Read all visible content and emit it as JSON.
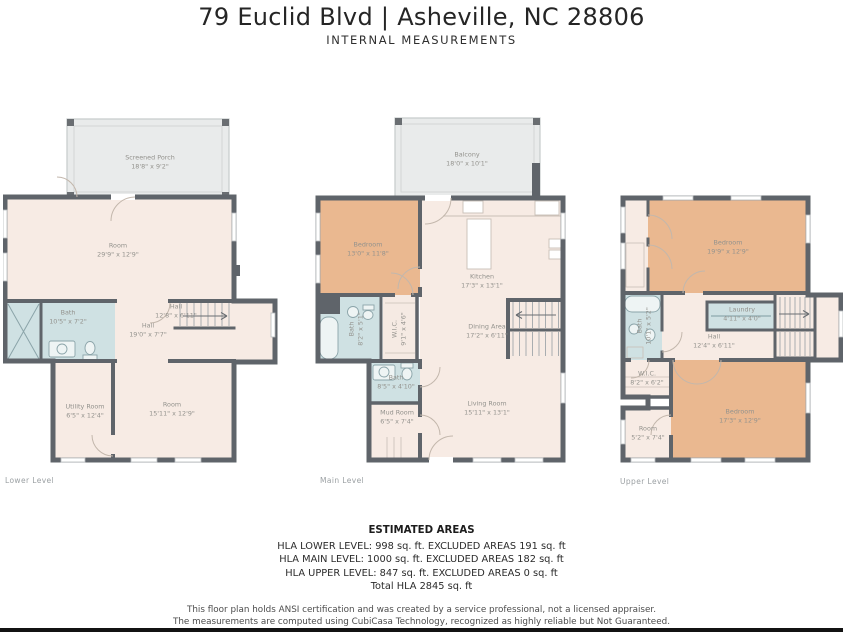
{
  "header": {
    "title": "79 Euclid Blvd | Asheville, NC 28806",
    "subtitle": "INTERNAL MEASUREMENTS"
  },
  "levels": [
    {
      "label": "Lower Level",
      "rooms": [
        {
          "name": "Screened Porch",
          "dims": "18'8\" x 9'2\""
        },
        {
          "name": "Room",
          "dims": "29'9\" x 12'9\""
        },
        {
          "name": "Bath",
          "dims": "10'5\" x 7'2\""
        },
        {
          "name": "Hall",
          "dims": "12'8\" x 6'11\""
        },
        {
          "name": "Hall",
          "dims": "19'0\" x 7'7\""
        },
        {
          "name": "Utility Room",
          "dims": "6'5\" x 12'4\""
        },
        {
          "name": "Room",
          "dims": "15'11\" x 12'9\""
        }
      ]
    },
    {
      "label": "Main Level",
      "rooms": [
        {
          "name": "Balcony",
          "dims": "18'0\" x 10'1\""
        },
        {
          "name": "Bedroom",
          "dims": "13'0\" x 11'8\""
        },
        {
          "name": "Kitchen",
          "dims": "17'3\" x 13'1\""
        },
        {
          "name": "Bath",
          "dims": "8'2\" x 5'1\""
        },
        {
          "name": "W.I.C.",
          "dims": "9'1\" x 4'6\""
        },
        {
          "name": "Dining Area",
          "dims": "17'2\" x 6'11\""
        },
        {
          "name": "Bath",
          "dims": "8'5\" x 4'10\""
        },
        {
          "name": "Mud Room",
          "dims": "6'5\" x 7'4\""
        },
        {
          "name": "Living Room",
          "dims": "15'11\" x 13'1\""
        }
      ]
    },
    {
      "label": "Upper Level",
      "rooms": [
        {
          "name": "Bedroom",
          "dims": "19'9\" x 12'9\""
        },
        {
          "name": "Bath",
          "dims": "10'1\" x 5'2\""
        },
        {
          "name": "Laundry",
          "dims": "4'11\" x 4'0\""
        },
        {
          "name": "Hall",
          "dims": "12'4\" x 6'11\""
        },
        {
          "name": "W.I.C.",
          "dims": "8'2\" x 6'2\""
        },
        {
          "name": "Room",
          "dims": "5'2\" x 7'4\""
        },
        {
          "name": "Bedroom",
          "dims": "17'3\" x 12'9\""
        }
      ]
    }
  ],
  "areas": {
    "title": "ESTIMATED AREAS",
    "lines": [
      "HLA LOWER LEVEL:  998 sq. ft. EXCLUDED AREAS 191 sq. ft",
      "HLA MAIN LEVEL: 1000 sq. ft. EXCLUDED AREAS 182 sq. ft",
      "HLA UPPER LEVEL: 847 sq. ft. EXCLUDED AREAS 0 sq. ft",
      "Total HLA 2845 sq. ft"
    ]
  },
  "footer": {
    "line1": "This floor plan holds ANSI certification and was created by a service professional, not a licensed appraiser.",
    "line2": "The measurements are computed using CubiCasa Technology, recognized as highly reliable but Not Guaranteed."
  },
  "colors": {
    "wall": "#5f646a",
    "room_fill": "#f7ebe4",
    "bedroom_fill": "#eab890",
    "bath_fill": "#cfe1e3",
    "porch_fill": "#e9ebeb",
    "label_text": "#93928d",
    "footer_bar": "#131313"
  }
}
